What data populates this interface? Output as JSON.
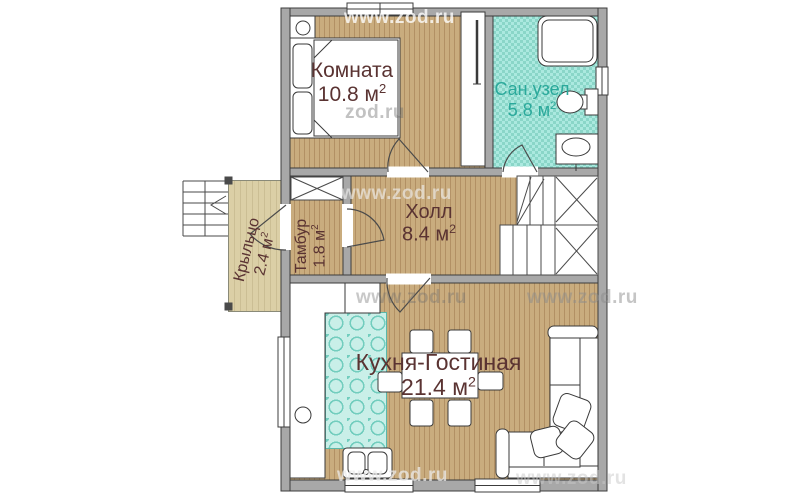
{
  "plan": {
    "rooms": [
      {
        "id": "bedroom",
        "name": "Комната",
        "area": "10.8 м",
        "sup": "2"
      },
      {
        "id": "bathroom",
        "name": "Сан.узел",
        "area": "5.8 м",
        "sup": "2"
      },
      {
        "id": "hall",
        "name": "Холл",
        "area": "8.4 м",
        "sup": "2"
      },
      {
        "id": "tambour",
        "name": "Тамбур",
        "area": "1.8 м",
        "sup": "2"
      },
      {
        "id": "porch",
        "name": "Крыльцо",
        "area": "2.4 м",
        "sup": "2"
      },
      {
        "id": "kitchen_living",
        "name": "Кухня-Гостиная",
        "area": "21.4 м",
        "sup": "2"
      }
    ],
    "watermarks": [
      {
        "text": "www.zod.ru"
      },
      {
        "text": "zod.ru"
      },
      {
        "text": "www.zod.ru"
      },
      {
        "text": "www.zod.ru"
      },
      {
        "text": "www.zod.ru"
      },
      {
        "text": "www.zod.ru"
      },
      {
        "text": "www.zod.ru"
      }
    ],
    "colors": {
      "wood_floor": "#c9ac7e",
      "bath_tile": "#9adfd3",
      "kitchen_tile": "#c9efe8",
      "porch_floor": "#dbcfa6",
      "wall": "#a8a8a8",
      "label_maroon": "#5a3332",
      "label_teal": "#2aa99b"
    }
  }
}
